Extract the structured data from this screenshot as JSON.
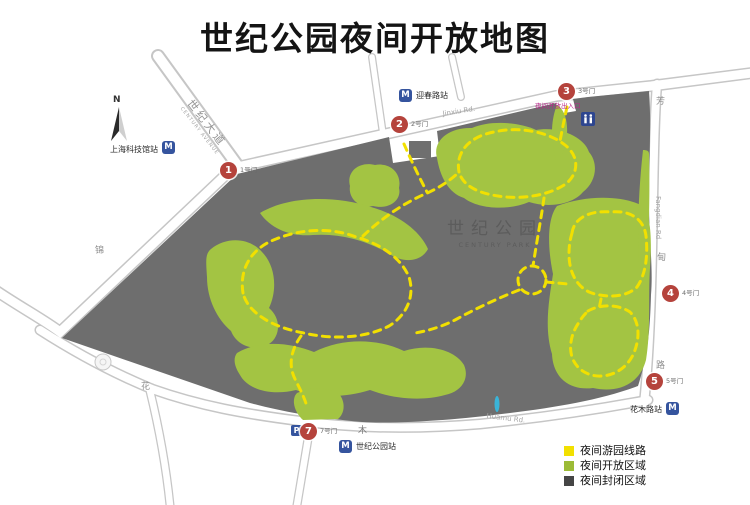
{
  "title": "世纪公园夜间开放地图",
  "compass": {
    "label": "N"
  },
  "park": {
    "name": "世纪公园",
    "name_en": "CENTURY PARK"
  },
  "legend": {
    "items": [
      {
        "label": "夜间游园线路",
        "color": "#f2e000"
      },
      {
        "label": "夜间开放区域",
        "color": "#9cbb36"
      },
      {
        "label": "夜间封闭区域",
        "color": "#454545"
      }
    ]
  },
  "gates": [
    {
      "number": "1",
      "label": "1号门"
    },
    {
      "number": "2",
      "label": "2号门"
    },
    {
      "number": "3",
      "label": "3号门"
    },
    {
      "number": "4",
      "label": "4号门"
    },
    {
      "number": "5",
      "label": "5号门"
    },
    {
      "number": "7",
      "label": "7号门"
    }
  ],
  "stations": [
    {
      "name": "上海科技馆站"
    },
    {
      "name": "迎春路站"
    },
    {
      "name": "世纪公园站"
    },
    {
      "name": "花木路站"
    }
  ],
  "roads": {
    "century_avenue": {
      "name": "世纪大道",
      "en": "CENTURY AVENUE"
    },
    "jinxiu": {
      "char": "锦",
      "en": "Jinxiu Rd."
    },
    "fangdian": {
      "char1": "芳",
      "char2": "甸",
      "char3": "路",
      "en": "Fangdian Rd"
    },
    "huamu": {
      "char1": "花",
      "char2": "木",
      "en": "Huamu Rd."
    }
  },
  "annotations": {
    "night_entrance": "夜间开放出入口"
  },
  "icons": {
    "metro": "M",
    "parking": "P"
  },
  "colors": {
    "closed_area": "#6e6e6e",
    "open_area": "#a3c443",
    "route": "#f2e000",
    "gate_marker": "#b5433c",
    "metro_blue": "#35549e"
  }
}
